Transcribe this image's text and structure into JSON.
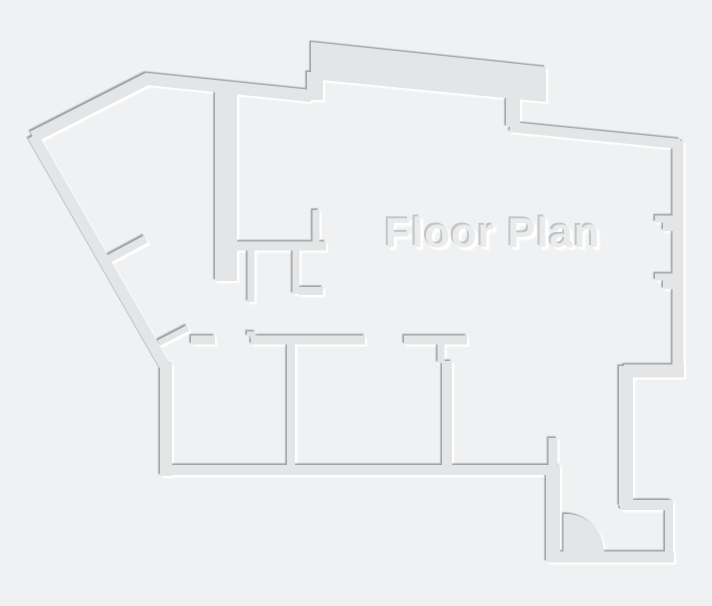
{
  "title": "Floor Plan",
  "colors": {
    "background": "#f0f1f2",
    "wall_fill": "#e3e5e6",
    "edge_shadow": "#9b9ea1",
    "edge_highlight": "#ffffff",
    "title_fill": "#eaebec",
    "title_shadow_dark": "#c3c5c7",
    "title_shadow_light": "#ffffff"
  }
}
